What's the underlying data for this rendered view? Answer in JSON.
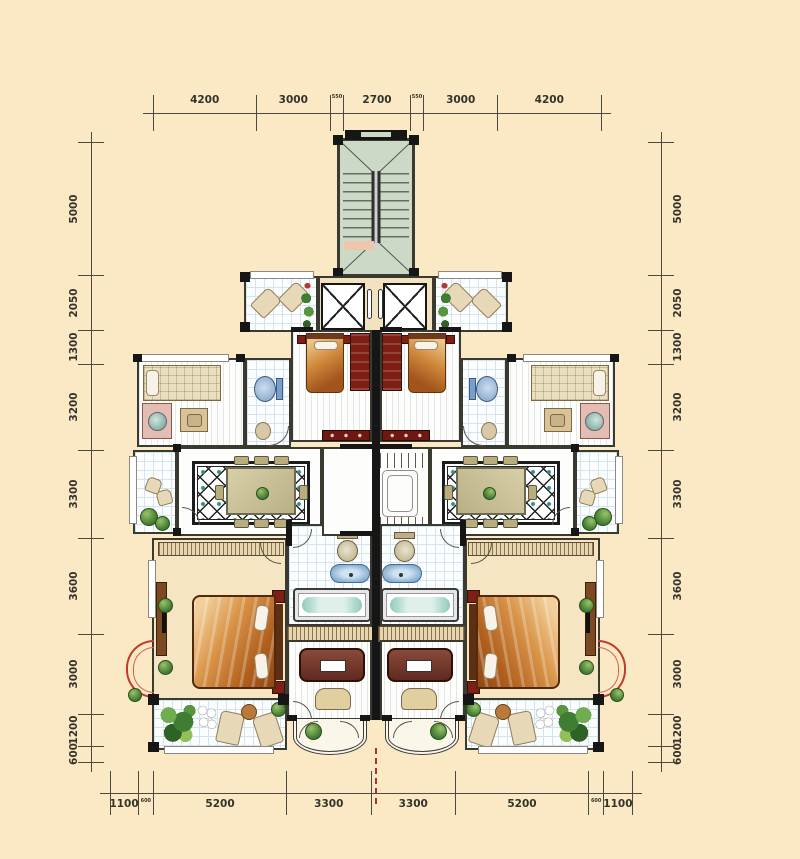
{
  "canvas": {
    "width": 800,
    "height": 859,
    "background": "#fbe9c6"
  },
  "rulers": {
    "top": {
      "segments": [
        "4200",
        "3000",
        "550",
        "2700",
        "550",
        "3000",
        "4200"
      ]
    },
    "bottom": {
      "segments": [
        "1100",
        "600",
        "5200",
        "3300",
        "3300",
        "5200",
        "600",
        "1100"
      ]
    },
    "left": {
      "segments": [
        "5000",
        "2050",
        "1300",
        "3200",
        "3300",
        "3600",
        "3000",
        "1200",
        "600"
      ]
    },
    "right": {
      "segments": [
        "5000",
        "2050",
        "1300",
        "3200",
        "3300",
        "3600",
        "3000",
        "1200",
        "600"
      ]
    }
  },
  "plan": {
    "colors": {
      "wall": "#161616",
      "stair_green": "#ccd9c6",
      "floor_cream": "#f5e5c2",
      "lobby_cream": "#f3e2c0",
      "tile_line": "#d3e4ef",
      "cabinet_dark_red": "#6e1713",
      "bed_orange": "#b55f1d",
      "accent_teal": "#2e8f8a",
      "bay_arc_red": "#c23b2a",
      "plant_green": "#4c8438"
    }
  }
}
